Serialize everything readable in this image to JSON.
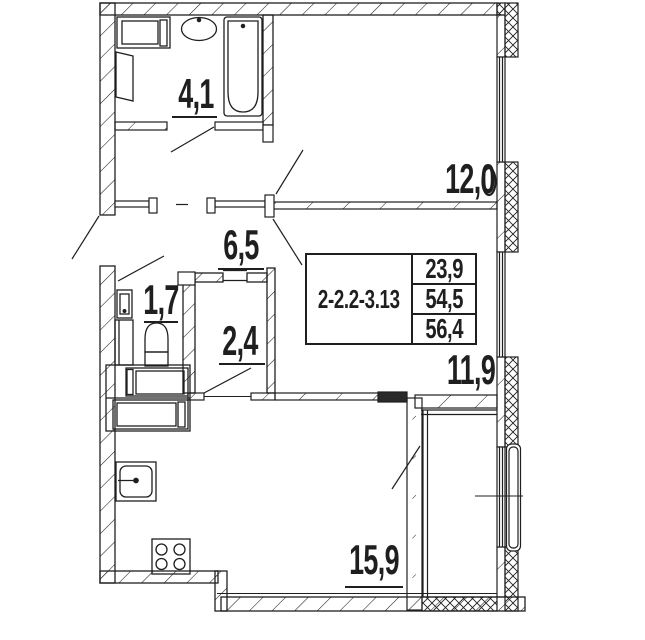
{
  "rooms": {
    "bathroom": {
      "area": "4,1"
    },
    "bedroom_top": {
      "area": "12,0"
    },
    "hallway": {
      "area": "6,5"
    },
    "wc": {
      "area": "1,7"
    },
    "pantry": {
      "area": "2,4"
    },
    "bedroom_right": {
      "area": "11,9"
    },
    "kitchen_living": {
      "area": "15,9"
    }
  },
  "info_box": {
    "unit_code": "2-2.2-3.13",
    "values": {
      "top": "23,9",
      "middle": "54,5",
      "bottom": "56,4"
    }
  },
  "fixtures": [
    "washing-machine",
    "bath-sink",
    "bathtub",
    "toilet",
    "wc-sink",
    "counter-appliances",
    "kitchen-sink",
    "stove",
    "radiator-window"
  ],
  "colors": {
    "line": "#1f1f1f",
    "background": "#ffffff"
  }
}
